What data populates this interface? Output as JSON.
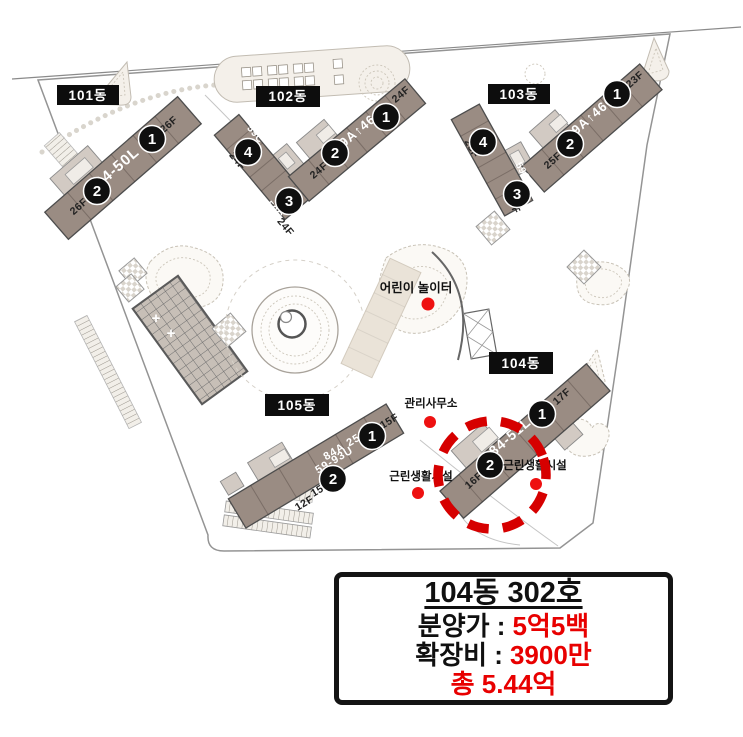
{
  "site_plan": {
    "dongs": {
      "d101": {
        "label": "101동",
        "unit": "84-50L",
        "n1": "1",
        "n2": "2",
        "f1": "26F",
        "f2": "26F"
      },
      "d102": {
        "label": "102동",
        "n1": "1",
        "n2": "2",
        "n3": "3",
        "n4": "4",
        "unit_main": "59A↑46C↓",
        "unit_w3": "59C",
        "unit_w4": "59C",
        "f1": "24F",
        "f2": "24F",
        "f3": "24F",
        "f4": "24F"
      },
      "d103": {
        "label": "103동",
        "n1": "1",
        "n2": "2",
        "n3": "3",
        "n4": "4",
        "unit_main": "59A↑46C↓",
        "unit_w3": "59C",
        "unit_w4": "59C",
        "f1": "23F",
        "f2": "25F",
        "f3": "25F",
        "f4": "25F"
      },
      "d104": {
        "label": "104동",
        "unit": "84-51L",
        "n1": "1",
        "n2": "2",
        "f1": "17F",
        "f2": "16F"
      },
      "d105": {
        "label": "105동",
        "unit_a": "84A 25L",
        "unit_b": "59-93U",
        "n1": "1",
        "n2": "2",
        "f1": "15F",
        "f2": "15F",
        "f3": "12F"
      }
    },
    "pois": {
      "playground": "어린이 놀이터",
      "office": "관리사무소",
      "retail_a": "근린생활시설",
      "retail_b": "근린생활시설"
    }
  },
  "info_box": {
    "title": "104동 302호",
    "price_label": "분양가 :",
    "price_value": "5억5백",
    "extension_label": "확장비 :",
    "extension_value": "3900만",
    "total": "총 5.44억"
  },
  "colors": {
    "building": "#9a8c83",
    "building_light": "#d2cac3",
    "label_bg": "#0d0d0d",
    "red_dot": "#ee1111",
    "highlight_red": "#d60000",
    "price_red": "#e80000"
  }
}
